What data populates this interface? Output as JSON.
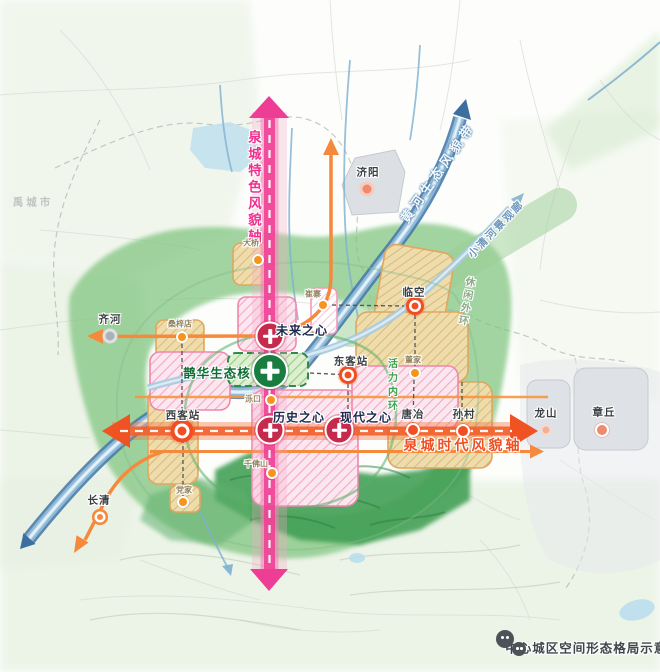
{
  "figure": {
    "caption": "中心城区空间形态格局示意图"
  },
  "axes": {
    "spring_character": {
      "label": "泉城特色风貌轴",
      "color": "#ee2f8e",
      "orientation": "vertical"
    },
    "yellow_river": {
      "label": "黄河生态风貌带",
      "color": "#4a7fae",
      "orientation": "diagonal"
    },
    "spring_era": {
      "label": "泉城时代风貌轴",
      "color": "#f04e23",
      "orientation": "horizontal"
    },
    "xiaoqing_river": {
      "label": "小清河景观廊",
      "color": "#6d95ba",
      "orientation": "diagonal"
    }
  },
  "rings": {
    "inner": {
      "label": "活力内环"
    },
    "outer": {
      "label": "休闲外环"
    }
  },
  "cores": {
    "future": {
      "label": "未来之心"
    },
    "history": {
      "label": "历史之心"
    },
    "modern": {
      "label": "现代之心"
    },
    "queshan_eco": {
      "label": "鹊华生态核"
    }
  },
  "nodes": {
    "qihe": {
      "label": "齐河"
    },
    "jiyang": {
      "label": "济阳"
    },
    "linkong": {
      "label": "临空"
    },
    "dongkezhan": {
      "label": "东客站"
    },
    "xikezhan": {
      "label": "西客站"
    },
    "tangye": {
      "label": "唐冶"
    },
    "suncun": {
      "label": "孙村"
    },
    "longshan": {
      "label": "龙山"
    },
    "zhangqiu": {
      "label": "章丘"
    },
    "changqing": {
      "label": "长清"
    }
  },
  "minor_nodes": {
    "sangzidian": {
      "label": "桑梓店"
    },
    "daqiao": {
      "label": "大桥"
    },
    "cuizhai": {
      "label": "崔寨"
    },
    "luokou": {
      "label": "泺口"
    },
    "qianfoshan": {
      "label": "千佛山"
    },
    "dangjia": {
      "label": "党家"
    },
    "dongjia": {
      "label": "董家"
    }
  },
  "adjacent": {
    "yucheng": {
      "label": "禹城市"
    }
  },
  "colors": {
    "axis_pink": "#ee2f8e",
    "axis_orange": "#f15a24",
    "river_blue": "#4679aa",
    "xiaoqing_blue": "#a7cade",
    "eco_green": "#187d3e",
    "heart_red": "#c62a4c",
    "minor_dot": "#f7941d"
  }
}
